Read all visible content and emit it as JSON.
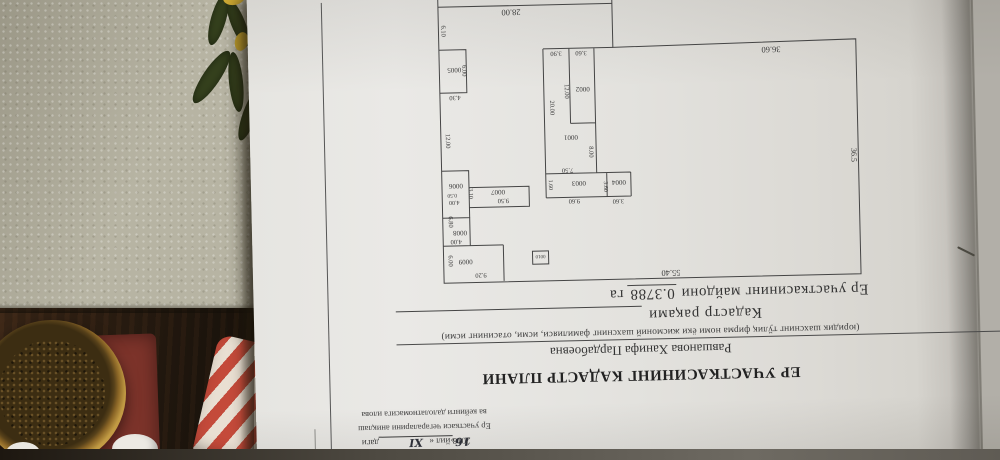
{
  "attachment_header": {
    "date_prefix": "2018 йил «",
    "date_day": "16",
    "date_close": "»",
    "date_month": "ХI",
    "date_suffix": "даги",
    "line2": "Ер участкаси чегараларини аниқлаш",
    "line3": "ва кейинги далолатномасига илова"
  },
  "title": "ЕР УЧАСТКАСИНИНГ КАДАСТР ПЛАНИ",
  "owner": {
    "name": "Равшанова Ханифа Пардабоевна",
    "caption": "(юридик шахснинг тўлиқ фирма номи ёки жисмоний шахснинг фамилияси, исми, отасининг исми)"
  },
  "cadastre": {
    "label": "Кадастр рақами"
  },
  "area": {
    "label": "Ер участкасининг майдони",
    "value": "0.3788",
    "unit": "га"
  },
  "plan": {
    "area_total_ga": "0.3788",
    "boundary_dims": [
      "55.40",
      "36.5",
      "36.60",
      "28.00",
      "12.00",
      "6.10"
    ],
    "parcel_ids": [
      "0001",
      "0002",
      "0003",
      "0004",
      "0005",
      "0006",
      "0007",
      "0008",
      "0009",
      "0010"
    ],
    "labels": [
      {
        "t": "55.40",
        "x": 198,
        "y": 12,
        "s": 8.5,
        "n": "boundary-dim-label"
      },
      {
        "t": "36.5",
        "x": 15,
        "y": 123,
        "r": -90,
        "s": 8,
        "n": "boundary-dim-label"
      },
      {
        "t": "36.60",
        "x": 93,
        "y": 233,
        "s": 8.5,
        "n": "boundary-dim-label"
      },
      {
        "t": "28.00",
        "x": 352,
        "y": 276,
        "s": 8.5,
        "n": "boundary-dim-label"
      },
      {
        "t": "12.00",
        "x": 420,
        "y": 146,
        "r": -90,
        "s": 6.5,
        "n": "plan-dim-label"
      },
      {
        "t": "6.10",
        "x": 422,
        "y": 256,
        "r": -90,
        "s": 6.5,
        "n": "plan-dim-label"
      },
      {
        "t": "20.00",
        "x": 315,
        "y": 177,
        "r": -90,
        "s": 6.5,
        "n": "plan-dim-label"
      },
      {
        "t": "3.90",
        "x": 308,
        "y": 233,
        "s": 6.5,
        "n": "plan-dim-label"
      },
      {
        "t": "3.60",
        "x": 283,
        "y": 233,
        "s": 6.5,
        "n": "plan-dim-label"
      },
      {
        "t": "12.00",
        "x": 300,
        "y": 193,
        "r": -90,
        "s": 6.5,
        "n": "plan-dim-label"
      },
      {
        "t": "8.00",
        "x": 277,
        "y": 132,
        "r": -90,
        "s": 6.5,
        "n": "plan-dim-label"
      },
      {
        "t": "7.50",
        "x": 299,
        "y": 116,
        "s": 6.5,
        "n": "plan-dim-label"
      },
      {
        "t": "9.60",
        "x": 293,
        "y": 85,
        "s": 6.5,
        "n": "plan-dim-label"
      },
      {
        "t": "1.60",
        "x": 318,
        "y": 100,
        "r": -90,
        "s": 6,
        "n": "plan-dim-label"
      },
      {
        "t": "3.60",
        "x": 263,
        "y": 97,
        "r": -90,
        "s": 6,
        "n": "plan-dim-label"
      },
      {
        "t": "3.60",
        "x": 249,
        "y": 84,
        "s": 6.5,
        "n": "plan-dim-label"
      },
      {
        "t": "4.30",
        "x": 410,
        "y": 191,
        "s": 6.5,
        "n": "plan-dim-label"
      },
      {
        "t": "6.00",
        "x": 402,
        "y": 216,
        "r": -90,
        "s": 6.5,
        "n": "plan-dim-label"
      },
      {
        "t": "0.50",
        "x": 415,
        "y": 93,
        "s": 5.5,
        "n": "plan-dim-label"
      },
      {
        "t": "4.00",
        "x": 413,
        "y": 86,
        "s": 6,
        "n": "plan-dim-label"
      },
      {
        "t": "3.10",
        "x": 398,
        "y": 93,
        "r": -90,
        "s": 6,
        "n": "plan-dim-label"
      },
      {
        "t": "9.50",
        "x": 364,
        "y": 87,
        "s": 6.5,
        "n": "plan-dim-label"
      },
      {
        "t": "6.80",
        "x": 419,
        "y": 65,
        "r": -90,
        "s": 6.5,
        "n": "plan-dim-label"
      },
      {
        "t": "4.00",
        "x": 412,
        "y": 47,
        "s": 6.5,
        "n": "plan-dim-label"
      },
      {
        "t": "6.00",
        "x": 420,
        "y": 26,
        "r": -90,
        "s": 6.5,
        "n": "plan-dim-label"
      },
      {
        "t": "9.20",
        "x": 388,
        "y": 13,
        "s": 6.5,
        "n": "plan-dim-label"
      },
      {
        "t": "0001",
        "x": 295,
        "y": 149,
        "s": 7,
        "n": "parcel-id-label"
      },
      {
        "t": "0002",
        "x": 282,
        "y": 197,
        "s": 7,
        "n": "parcel-id-label"
      },
      {
        "t": "0003",
        "x": 288,
        "y": 103,
        "s": 7,
        "n": "parcel-id-label"
      },
      {
        "t": "0004",
        "x": 248,
        "y": 103,
        "s": 7,
        "n": "parcel-id-label"
      },
      {
        "t": "0005",
        "x": 410,
        "y": 219,
        "s": 7,
        "n": "parcel-id-label"
      },
      {
        "t": "0006",
        "x": 411,
        "y": 103,
        "s": 7,
        "n": "parcel-id-label"
      },
      {
        "t": "0007",
        "x": 369,
        "y": 96,
        "s": 7,
        "n": "parcel-id-label"
      },
      {
        "t": "0008",
        "x": 408,
        "y": 56,
        "s": 7,
        "n": "parcel-id-label"
      },
      {
        "t": "0009",
        "x": 403,
        "y": 27,
        "s": 7,
        "n": "parcel-id-label"
      },
      {
        "t": "0010",
        "x": 328,
        "y": 30,
        "s": 5,
        "n": "parcel-id-label"
      }
    ]
  },
  "colors": {
    "wall": "#b7b4a3",
    "table_wood": "#241a10",
    "mat_red": "#7c332a",
    "bowl_rim": "#c19a43",
    "jar_red": "#c44a3a",
    "paper": "#e3e2de",
    "ink": "#3a3a3a"
  }
}
